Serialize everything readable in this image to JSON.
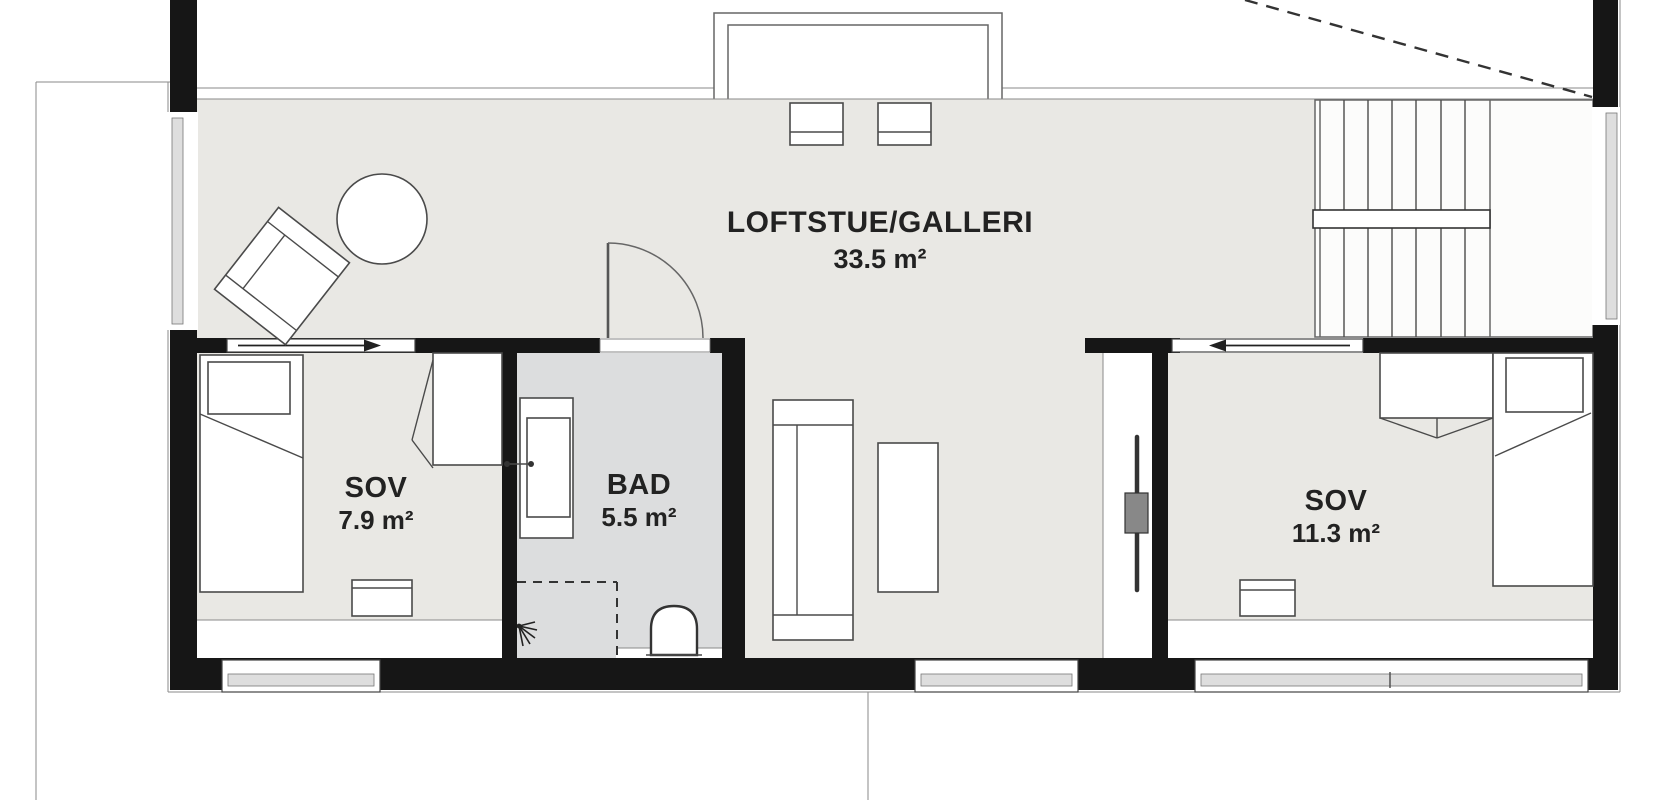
{
  "plan": {
    "rooms": {
      "loft": {
        "name": "LOFTSTUE/GALLERI",
        "area": "33.5 m²"
      },
      "bedroom_left": {
        "name": "SOV",
        "area": "7.9 m²"
      },
      "bathroom": {
        "name": "BAD",
        "area": "5.5 m²"
      },
      "bedroom_right": {
        "name": "SOV",
        "area": "11.3 m²"
      }
    },
    "colors": {
      "background": "#ffffff",
      "floor": "#e9e8e4",
      "bathroom_floor": "#dcddde",
      "wall": "#161616",
      "line": "#555555",
      "text": "#222222"
    }
  }
}
